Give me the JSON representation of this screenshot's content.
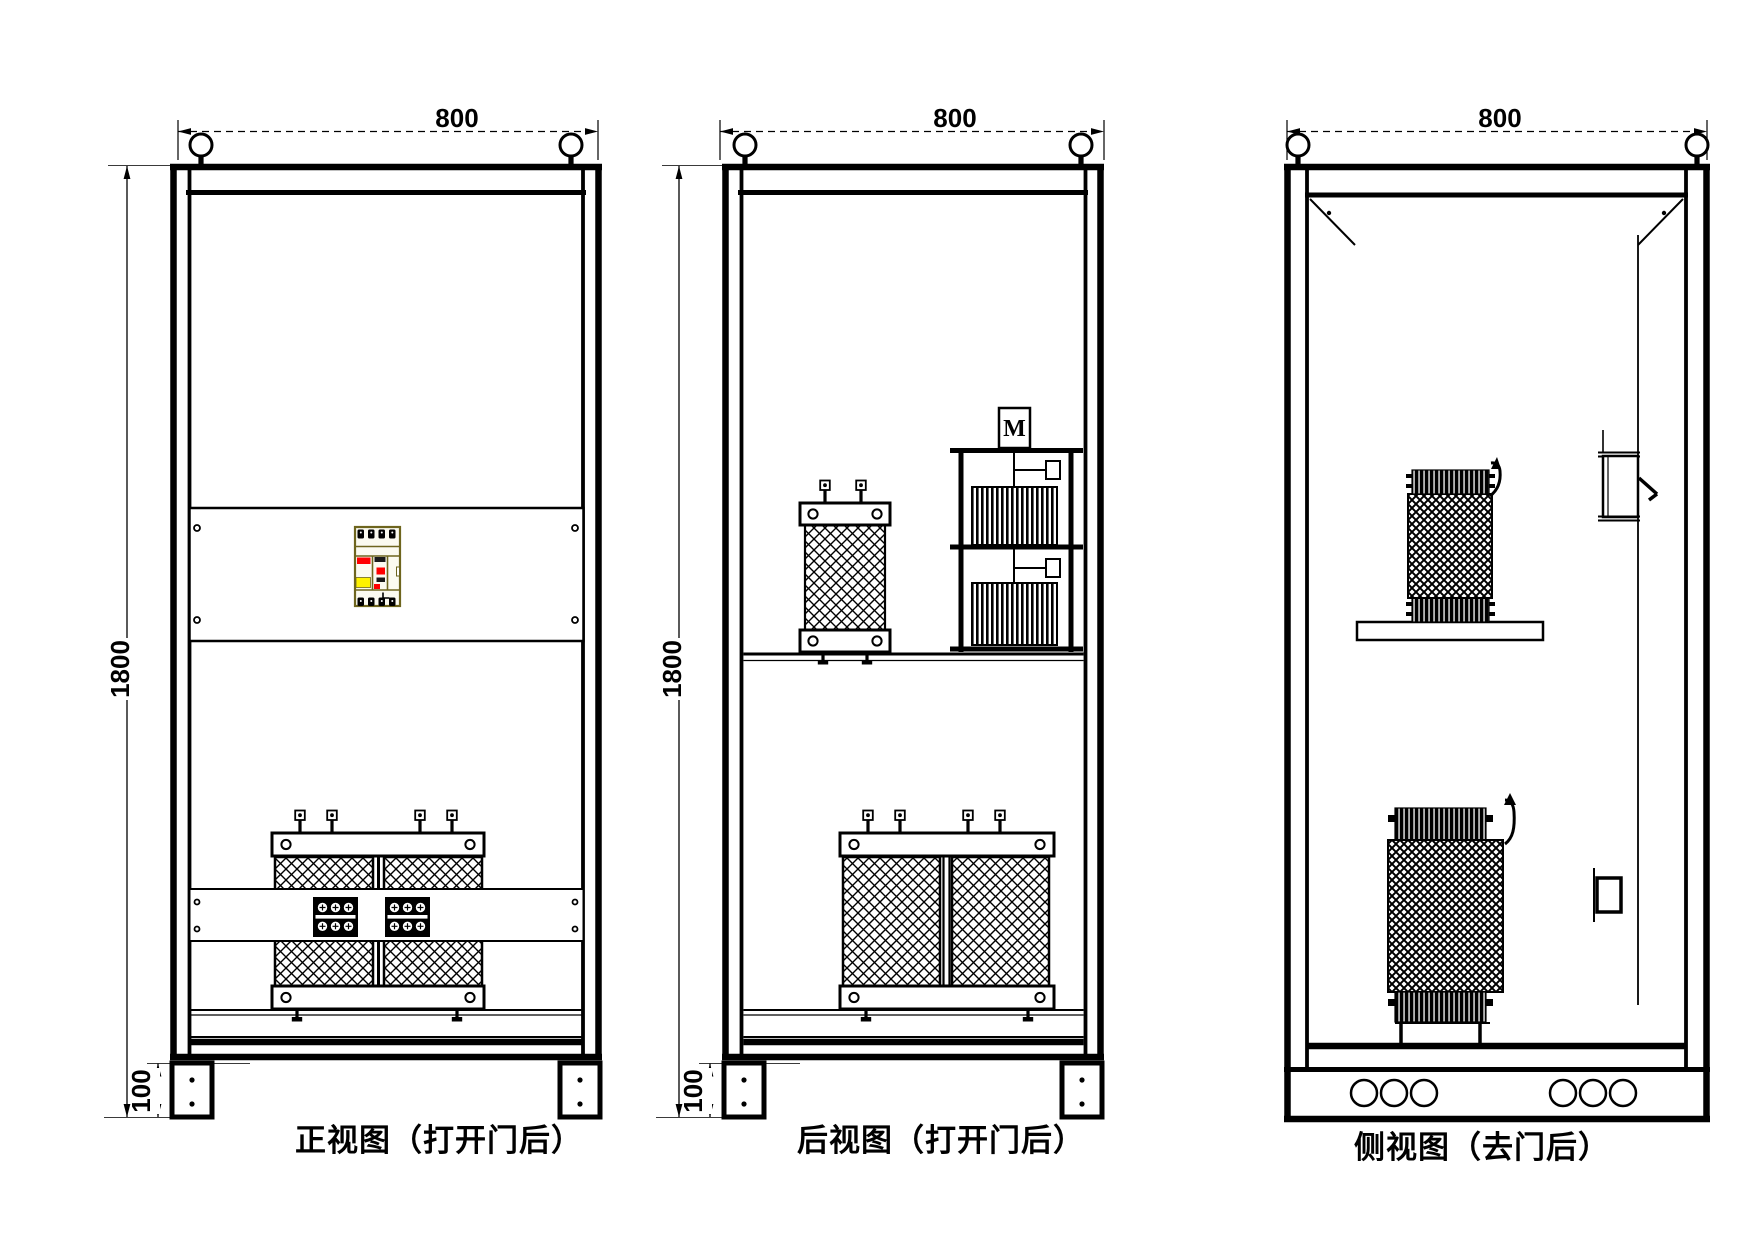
{
  "front": {
    "caption": "正视图（打开门后）",
    "width_label": "800",
    "height_label": "1800",
    "base_label": "100"
  },
  "rear": {
    "caption": "后视图（打开门后）",
    "width_label": "800",
    "height_label": "1800",
    "base_label": "100",
    "motor_label": "M"
  },
  "side": {
    "caption": "侧视图（去门后）",
    "width_label": "800"
  },
  "colors": {
    "line": "#000000",
    "background": "#FFFFFF",
    "breaker_outline": "#6E651E",
    "breaker_red": "#FF0000",
    "breaker_yellow": "#FFF200"
  }
}
